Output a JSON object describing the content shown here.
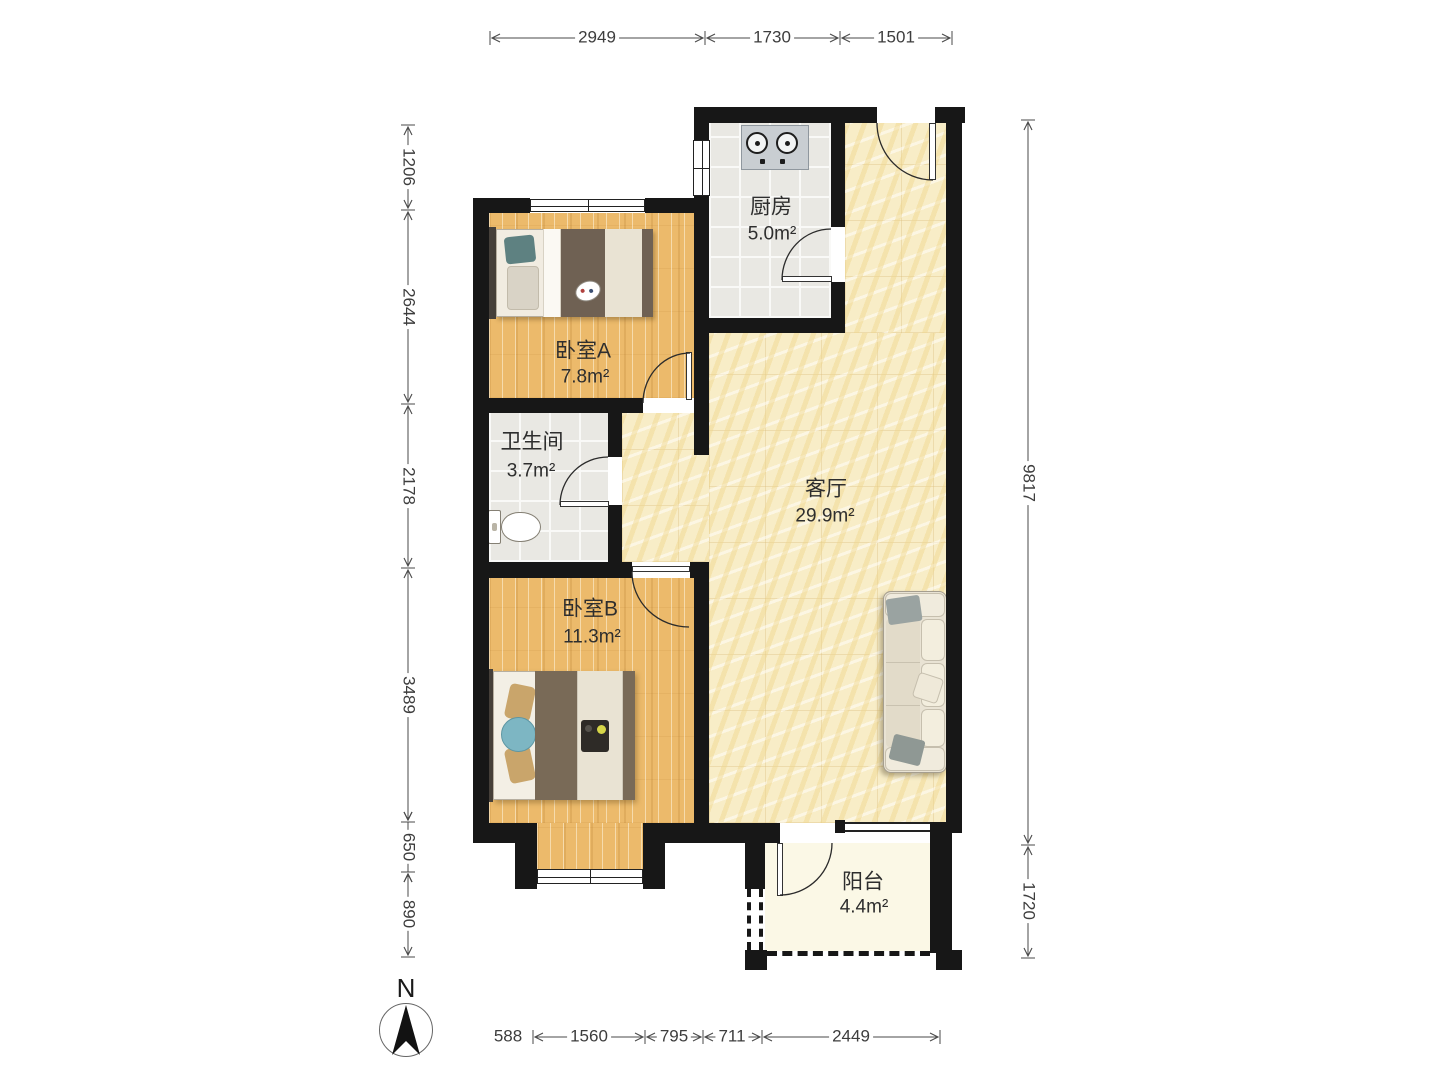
{
  "rooms": [
    {
      "name": "厨房",
      "area": "5.0m²"
    },
    {
      "name": "卧室A",
      "area": "7.8m²"
    },
    {
      "name": "卫生间",
      "area": "3.7m²"
    },
    {
      "name": "客厅",
      "area": "29.9m²"
    },
    {
      "name": "卧室B",
      "area": "11.3m²"
    },
    {
      "name": "阳台",
      "area": "4.4m²"
    }
  ],
  "dimensions": {
    "top": [
      "2949",
      "1730",
      "1501"
    ],
    "left": [
      "1206",
      "2644",
      "2178",
      "3489",
      "650",
      "890"
    ],
    "right": [
      "9817",
      "1720"
    ],
    "bottom": [
      "588",
      "1560",
      "795",
      "711",
      "2449"
    ]
  },
  "compass": {
    "label": "N"
  },
  "colors": {
    "wall": "#171717",
    "wood_floor": "#ecba6b",
    "tile_floor": "#e9e8e3",
    "marble_floor": "#f8edc7",
    "balcony_floor": "#fbf8e6",
    "dimension_text": "#3d3d3d"
  }
}
